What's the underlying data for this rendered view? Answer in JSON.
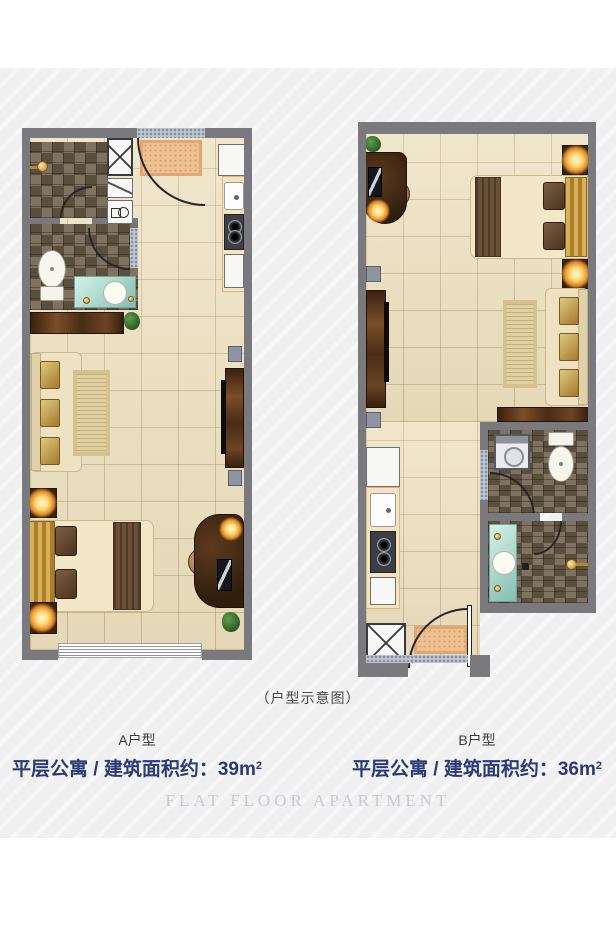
{
  "caption": "（户型示意图）",
  "units": [
    {
      "name": "A户型",
      "desc": "平层公寓 / 建筑面积约：",
      "area_value": "39m",
      "area_sup": "2"
    },
    {
      "name": "B户型",
      "desc": "平层公寓 / 建筑面积约：",
      "area_value": "36m",
      "area_sup": "2"
    }
  ],
  "footer": "FLAT FLOOR APARTMENT",
  "colors": {
    "wall": "#7a7a7e",
    "floor": "#ecdfbd",
    "bath_tile": "#6e5f4b",
    "accent_navy": "#2b3a78",
    "footer_text": "#c7cad7",
    "door_mat": "#eec193",
    "lamp_glow": "#ffd978",
    "wood": "#4a2c15",
    "vanity_teal": "#84beb2"
  },
  "plans": {
    "a": {
      "rooms": [
        "entry",
        "shower-room",
        "toilet-room",
        "kitchen",
        "living-sleeping-area"
      ],
      "furniture": [
        "wardrobe",
        "shoe-shelf",
        "wash-unit",
        "shower-head",
        "toilet",
        "vanity-sink",
        "fridge",
        "kitchen-sink",
        "stove",
        "sideboard",
        "sofa",
        "rug",
        "tv-cabinet",
        "speakers",
        "bed",
        "nightstands",
        "lamps",
        "desk",
        "chair",
        "monitor",
        "plants",
        "window",
        "entry-door",
        "door-mat"
      ]
    },
    "b": {
      "rooms": [
        "entry",
        "kitchen",
        "bathroom",
        "shower-room",
        "living-sleeping-area"
      ],
      "furniture": [
        "desk",
        "chair",
        "monitor",
        "plant",
        "bed",
        "nightstands",
        "lamps",
        "sofa",
        "rug",
        "tv-cabinet",
        "speakers",
        "sideboard",
        "fridge",
        "kitchen-sink",
        "stove",
        "wardrobe",
        "washing-machine",
        "toilet",
        "vanity-sink",
        "shower-head",
        "drain",
        "entry-door",
        "door-mat"
      ]
    }
  }
}
